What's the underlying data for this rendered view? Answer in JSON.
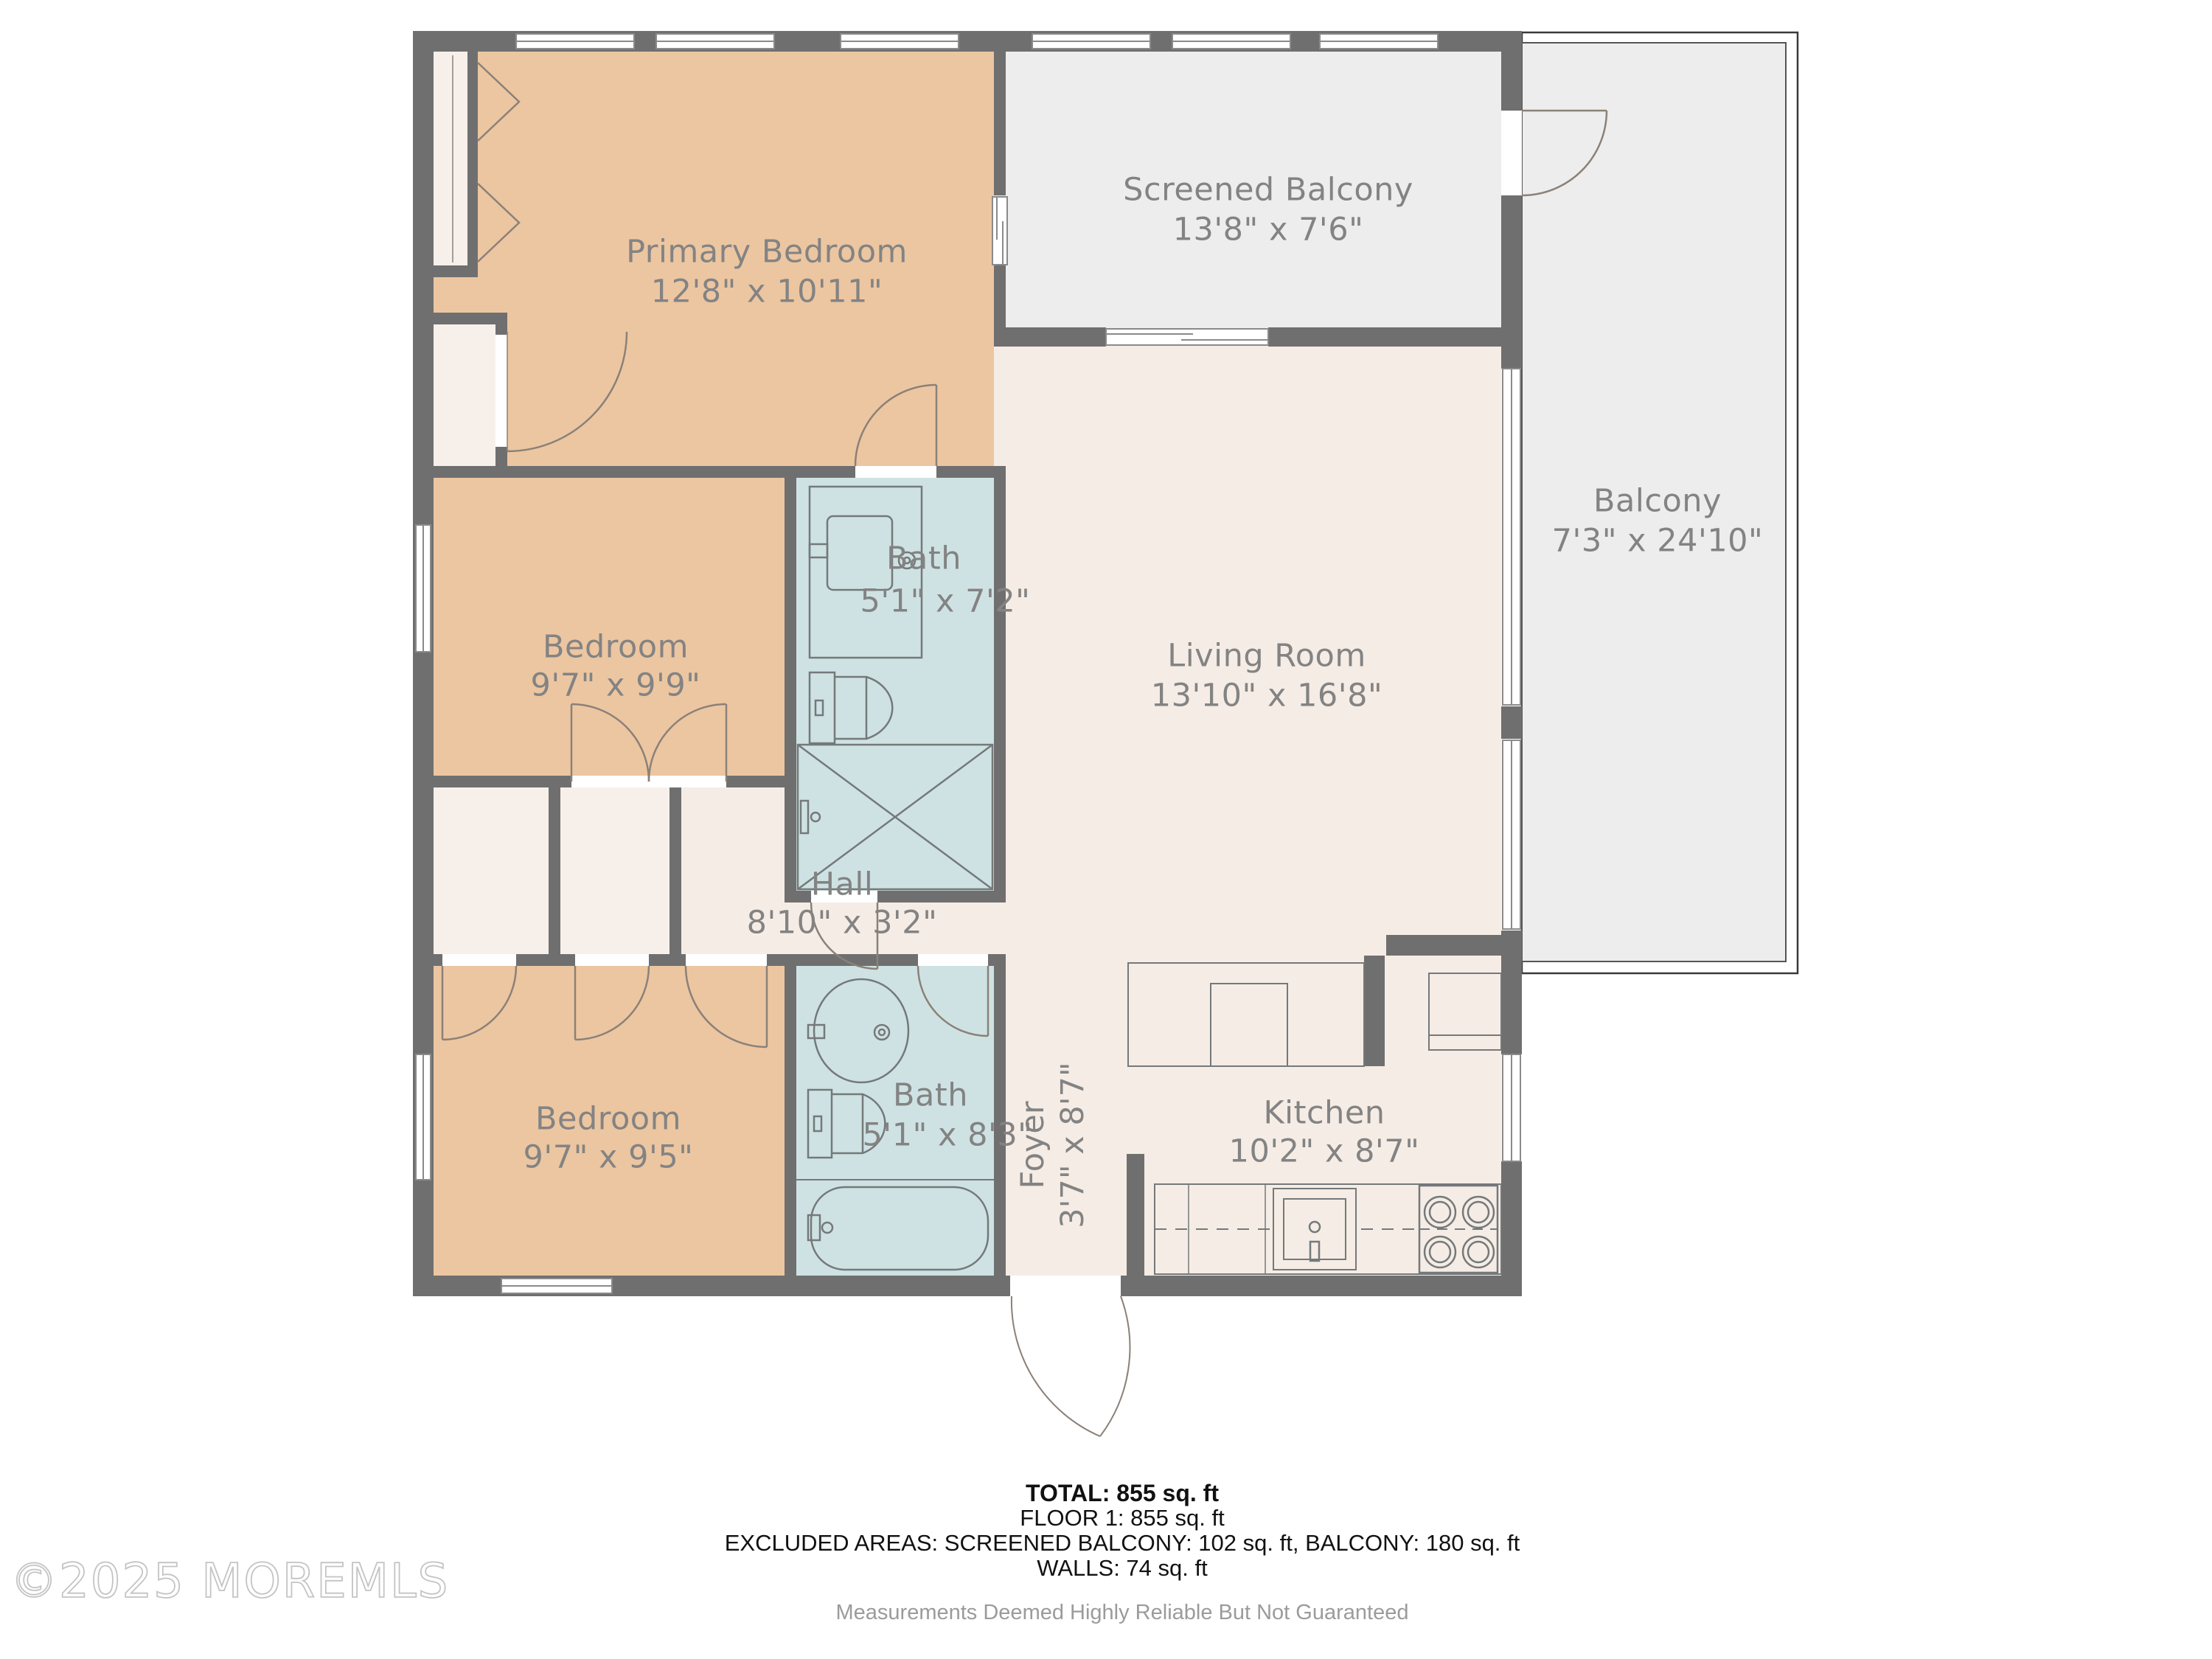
{
  "rooms": {
    "primary_bedroom": {
      "name": "Primary Bedroom",
      "dims": "12'8\" x 10'11\""
    },
    "screened_balcony": {
      "name": "Screened Balcony",
      "dims": "13'8\" x 7'6\""
    },
    "balcony": {
      "name": "Balcony",
      "dims": "7'3\" x 24'10\""
    },
    "bath_upper": {
      "name": "Bath",
      "dims": "5'1\" x 7'2\""
    },
    "bedroom_mid": {
      "name": "Bedroom",
      "dims": "9'7\" x 9'9\""
    },
    "living_room": {
      "name": "Living Room",
      "dims": "13'10\" x 16'8\""
    },
    "hall": {
      "name": "Hall",
      "dims": "8'10\" x 3'2\""
    },
    "bedroom_lower": {
      "name": "Bedroom",
      "dims": "9'7\" x 9'5\""
    },
    "bath_lower": {
      "name": "Bath",
      "dims": "5'1\" x 8'3\""
    },
    "foyer": {
      "name": "Foyer",
      "dims": "3'7\" x 8'7\""
    },
    "kitchen": {
      "name": "Kitchen",
      "dims": "10'2\" x 8'7\""
    }
  },
  "summary": {
    "total": "TOTAL: 855 sq. ft",
    "floor1": "FLOOR 1: 855 sq. ft",
    "excluded": "EXCLUDED AREAS: SCREENED BALCONY: 102 sq. ft, BALCONY: 180 sq. ft",
    "walls": "WALLS: 74 sq. ft",
    "disclaimer": "Measurements Deemed Highly Reliable But Not Guaranteed"
  },
  "watermark": "©2025 MOREMLS",
  "colors": {
    "wall": "#6f6f6f",
    "bedroom_fill": "#ecc6a1",
    "bath_fill": "#cfe2e3",
    "floor_fill": "#f5ece5",
    "closet_fill": "#f7f0ea",
    "balcony_fill": "#ededed",
    "label_text": "#838383",
    "fixture_stroke": "#74797a",
    "door_stroke": "#8b8178"
  }
}
